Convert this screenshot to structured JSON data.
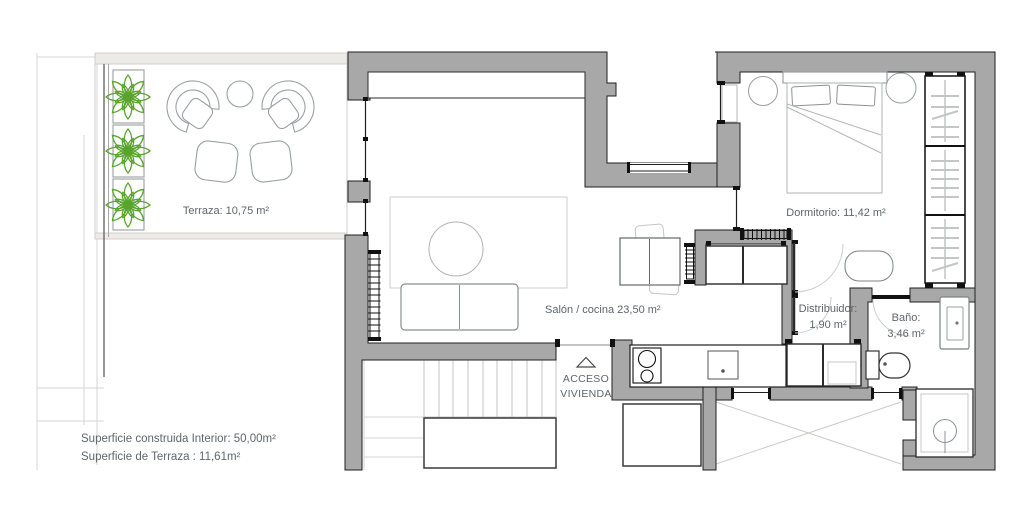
{
  "rooms": {
    "terraza": {
      "label": "Terraza: 10,75 m²"
    },
    "salon": {
      "label": "Salón / cocina 23,50 m²"
    },
    "dormitorio": {
      "label": "Dormitorio: 11,42 m²"
    },
    "distribuidor": {
      "name": "Distribuidor:",
      "area": "1,90 m²"
    },
    "bano": {
      "name": "Baño:",
      "area": "3,46 m²"
    }
  },
  "entrance": {
    "line1": "ACCESO",
    "line2": "VIVIENDA"
  },
  "summary": {
    "line1": "Superficie construida Interior: 50,00m²",
    "line2": "Superficie de Terraza : 11,61m²"
  },
  "icons": {
    "plant_icon": "flower-top-view",
    "entrance_arrow_icon": "triangle-up"
  },
  "colors": {
    "wall_fill": "#a8a8a8",
    "wall_outline": "#1f1f1f",
    "plant_green": "#58a42c",
    "label_text": "#5d666d",
    "furniture_line": "#9aa0a2",
    "light_structure": "#d8d5d1"
  }
}
